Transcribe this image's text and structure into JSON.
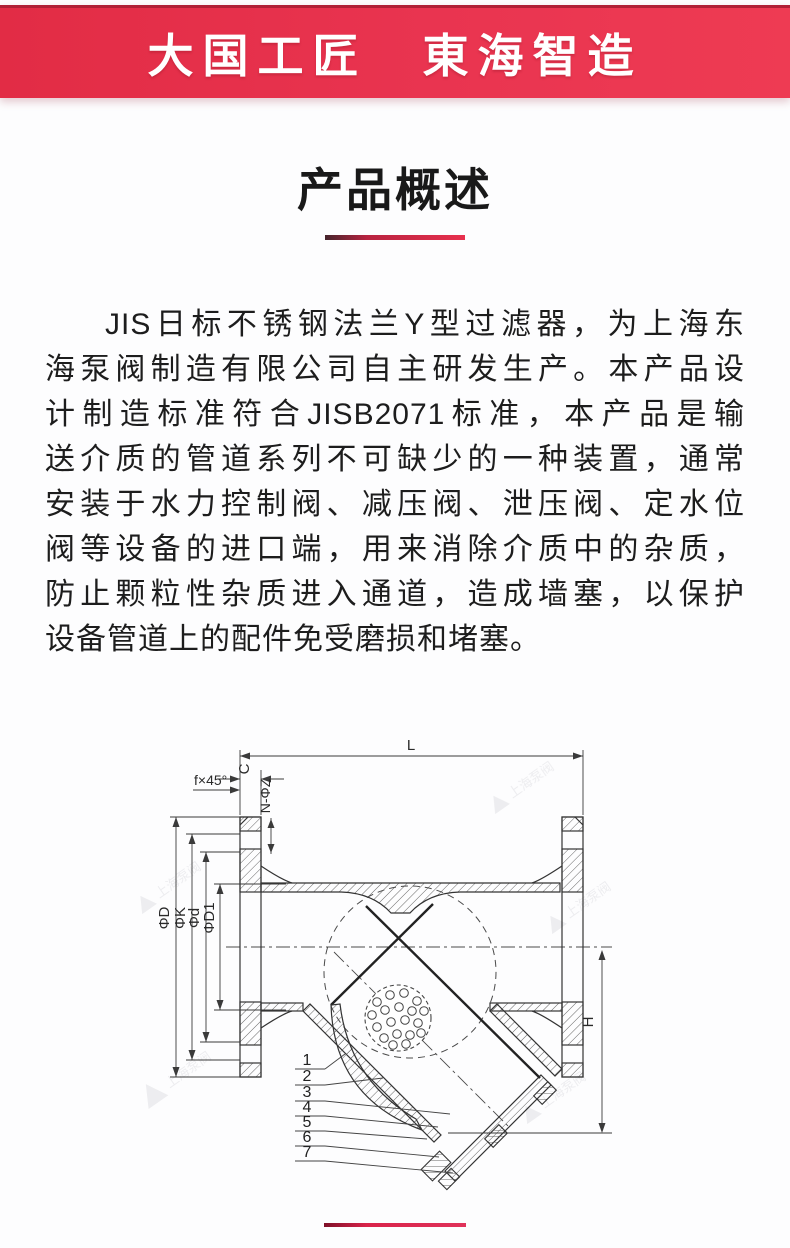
{
  "banner": {
    "title": "大国工匠　東海智造",
    "background_left": "#e22c45",
    "background_right": "#ee3b53",
    "top_edge_color": "#b02036",
    "text_color": "#ffffff"
  },
  "section": {
    "title": "产品概述",
    "underline_from": "#45242c",
    "underline_to": "#e8304e"
  },
  "paragraph": {
    "lines": [
      "JIS日标不锈钢法兰Y型过滤器，为上海东",
      "海泵阀制造有限公司自主研发生产。本产品设",
      "计制造标准符合JISB2071标准，本产品是输",
      "送介质的管道系列不可缺少的一种装置，通常",
      "安装于水力控制阀、减压阀、泄压阀、定水位",
      "阀等设备的进口端，用来消除介质中的杂质，",
      "防止颗粒性杂质进入通道，造成墙塞，以保护",
      "设备管道上的配件免受磨损和堵塞。"
    ]
  },
  "drawing": {
    "dimensions": {
      "length": "L",
      "flange_thickness": "C",
      "chamfer": "f×45°",
      "bolt_holes": "N-ΦZ",
      "flange_od": "ΦD",
      "bolt_circle": "ΦK",
      "raised_face": "Φd",
      "bore": "ΦD1",
      "height": "H"
    },
    "part_numbers": [
      "1",
      "2",
      "3",
      "4",
      "5",
      "6",
      "7"
    ],
    "watermark_text": "上海泵阀",
    "line_color": "#3a3a3a"
  },
  "footer": {
    "divider_color": "#d9234a"
  }
}
